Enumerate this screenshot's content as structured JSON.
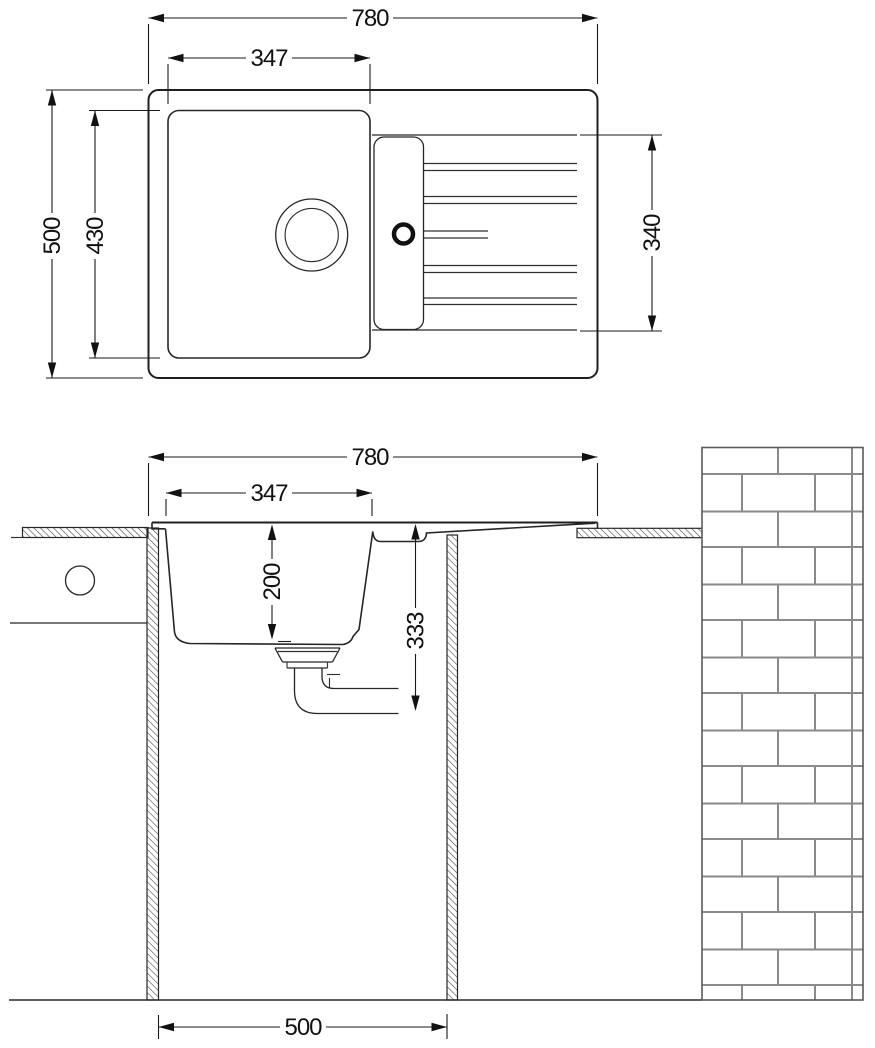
{
  "drawing": {
    "kind": "kitchen sink installation drawing",
    "views": {
      "top": "plan view of sink with bowl and drainboard",
      "section": "front section view with cabinet and brick wall"
    }
  },
  "dimensions": {
    "top": {
      "overall_width": "780",
      "bowl_width": "347",
      "overall_depth": "500",
      "bowl_length": "430",
      "drainboard_length": "340"
    },
    "section": {
      "overall_width": "780",
      "bowl_top_width": "347",
      "bowl_depth": "200",
      "installation_depth": "333",
      "cabinet_inner_width": "500"
    }
  },
  "colors": {
    "line": "#1f1f1f",
    "mortar": "#8a8a8a",
    "background": "#ffffff"
  }
}
